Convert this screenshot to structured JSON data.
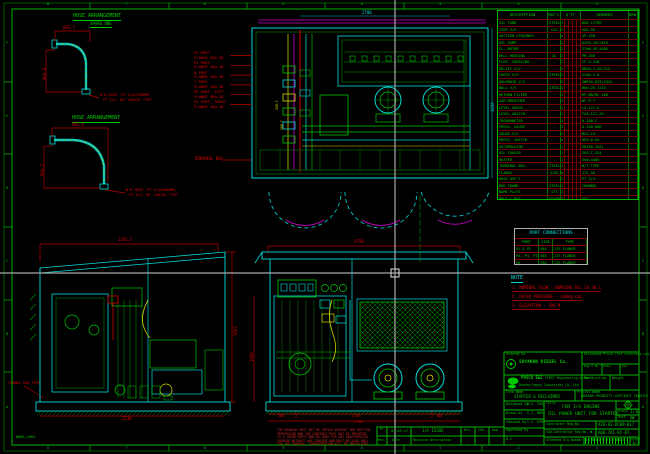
{
  "frame": {
    "corner_label": "WORK-2004",
    "ruler_numbers": [
      "8",
      "7",
      "6",
      "5",
      "4",
      "3",
      "2",
      "1"
    ],
    "ruler_letters": [
      "F",
      "E",
      "D",
      "C",
      "B",
      "A"
    ]
  },
  "colors": {
    "green": "#00c800",
    "cyan": "#00dcdc",
    "red": "#c80000",
    "yellow": "#d8d800",
    "magenta": "#cc00cc",
    "crosshair": "#aaaaaa"
  },
  "hose_arrangements": [
    {
      "title": "HOSE ARRANGEMENT",
      "subtitle": "SPARE ONE",
      "dim_w": "605.7",
      "dim_h": "450.8",
      "note_line1": "W'D HOSE, PT 3/4x1500MM",
      "note_line2": "PT 3/4, 90' SWIVEL TYPE"
    },
    {
      "title": "HOSE ARRANGEMENT",
      "subtitle": "",
      "dim_w": "905.5",
      "dim_h": "550.7",
      "note_line1": "W'D HOSE, PT 3/4x3000MM",
      "note_line2": "PT 3/4, 90' SWIVEL TYPE"
    }
  ],
  "plan_view": {
    "port_labels": [
      {
        "port": "P1 PORT",
        "flange": "FLANGE 50A-5K"
      },
      {
        "port": "P2 PORT",
        "flange": "FLANGE 50A-5K"
      },
      {
        "port": "N PORT",
        "flange": "FLANGE 40A-5K"
      },
      {
        "port": "T PORT",
        "flange": "FLANGE 50A-5K"
      },
      {
        "port": "P4 PORT, LEFT",
        "flange": "FLANGE 50A-5K"
      },
      {
        "port": "P5 PORT, RIGHT",
        "flange": "FLANGE 50A-5K"
      }
    ],
    "terminal_box": "TERMINAL BOX",
    "dim_top": "2700",
    "dim_right": "1650",
    "dim_a": "150.3",
    "dim_b": "100.7"
  },
  "bom": {
    "headers": {
      "description": "DESCRIPTION",
      "material": "MAT'L",
      "qty": "Q'TY",
      "remarks": "REMARKS",
      "dwg": "DRW'G NO"
    },
    "rows": [
      {
        "d": "OIL TANK",
        "m": "STEEL",
        "q": "1",
        "r": "800 LITER"
      },
      {
        "d": "STOP V/V",
        "m": "CAC",
        "q": "2",
        "r": "50A-5K"
      },
      {
        "d": "SUCTION STRAINER",
        "m": "-",
        "q": "2",
        "r": "SP-100"
      },
      {
        "d": "OIL PUMP",
        "m": "-",
        "q": "2",
        "r": "A2F0-107/61R"
      },
      {
        "d": "EL. MOTOR",
        "m": "-",
        "q": "2",
        "r": "37kW-4P-440V"
      },
      {
        "d": "BELL HOUSING",
        "m": "AL",
        "q": "2",
        "r": "PM-350"
      },
      {
        "d": "FLEX. COUPLING",
        "m": "-",
        "q": "2",
        "r": "CF-A-110"
      },
      {
        "d": "RELIEF V/V",
        "m": "-",
        "q": "2",
        "r": "DB20-2-50/315"
      },
      {
        "d": "CHECK V/V",
        "m": "STEEL",
        "q": "2",
        "r": "S20A-1.0"
      },
      {
        "d": "SOLENOID V/V",
        "m": "-",
        "q": "2",
        "r": "4WE10-D33/CG24"
      },
      {
        "d": "BALL V/V",
        "m": "STEEL",
        "q": "4",
        "r": "BKH-20-1113"
      },
      {
        "d": "RETURN FILTER",
        "m": "-",
        "q": "1",
        "r": "RF-BN/HC-160"
      },
      {
        "d": "AIR BREATHER",
        "m": "-",
        "q": "1",
        "r": "BF-P-7"
      },
      {
        "d": "LEVEL GAUGE",
        "m": "-",
        "q": "1",
        "r": "LS-127-A"
      },
      {
        "d": "LEVEL SWITCH",
        "m": "-",
        "q": "1",
        "r": "FSA-127-2X"
      },
      {
        "d": "THERMOMETER",
        "m": "-",
        "q": "1",
        "r": "0-100'C"
      },
      {
        "d": "PRESS. GAUGE",
        "m": "-",
        "q": "3",
        "r": "0-250 BAR"
      },
      {
        "d": "GAUGE V/V",
        "m": "-",
        "q": "3",
        "r": "BV2-10"
      },
      {
        "d": "PRESS. SWITCH",
        "m": "-",
        "q": "2",
        "r": "HED-8-OA"
      },
      {
        "d": "ACCUMULATOR",
        "m": "-",
        "q": "1",
        "r": "SB330-32A1"
      },
      {
        "d": "OIL COOLER",
        "m": "-",
        "q": "1",
        "r": "SUS-T-424"
      },
      {
        "d": "HEATER",
        "m": "-",
        "q": "1",
        "r": "3kW-440V"
      },
      {
        "d": "TERMINAL BOX",
        "m": "STEEL",
        "q": "1",
        "r": "W/T TYPE"
      },
      {
        "d": "FLANGE",
        "m": "S25C",
        "q": "6",
        "r": "JIS 5K"
      },
      {
        "d": "HOSE ASS'Y",
        "m": "-",
        "q": "2",
        "r": "PT 3/4"
      },
      {
        "d": "BED FRAME",
        "m": "STEEL",
        "q": "1",
        "r": "CHANNEL"
      },
      {
        "d": "NAME PLATE",
        "m": "STS",
        "q": "1",
        "r": "-"
      },
      {
        "d": "BOLT & NUT",
        "m": "SS400",
        "q": "1",
        "r": "SET"
      }
    ]
  },
  "port_connections": {
    "title": "PORT CONNECTIONS",
    "headers": [
      "PORT",
      "SIZE",
      "TYPE"
    ],
    "rows": [
      [
        "P1 & P2",
        "50A",
        "JIS FLANGE"
      ],
      [
        "P3, P4, P5",
        "40A",
        "JIS FLANGE"
      ],
      [
        "P6",
        "25A",
        "JIS FLANGE"
      ]
    ]
  },
  "notes": {
    "title": "NOTE",
    "items": [
      "1. NOMINAL FLOW - WORKING OIL 50 40 L",
      "2. RATED PRESSURE - 140kg/cm2",
      "3. ELEVATION : 700 M"
    ]
  },
  "side_view": {
    "dim_top": "2285.5",
    "dim_right": "1563",
    "dim_bottom": "2130",
    "label": "FLANGE 50A TYPE"
  },
  "front_view": {
    "dim_top": "2750",
    "dim_left": "1050",
    "dim_b1": "300",
    "dim_b2": "2150",
    "dim_b3": "300",
    "dim_total": "2750"
  },
  "warning_lines": [
    "THE DRAWING MUST NOT BE COPIED WITHOUT OUR WRITTEN",
    "PERMISSION AND THE CONTENTS MUST NOT BE IMPARTED",
    "TO A THIRD PARTY NOR BE USED FOR ANY UNAUTHORIZED",
    "PURPOSE WITHOUT OUR CONSENT AND MUST BE USED ONLY",
    "FOR THE PURPOSE. CONTRAVENTION WILL BE PROSECUTED."
  ],
  "revision": {
    "rev": "A",
    "date": "'04.03.17",
    "desc": "1st ISSUE",
    "col_rev": "Rev.",
    "col_date": "Date",
    "col_desc": "Revision Description",
    "sign_cols": [
      "Drw",
      "Chk",
      "App"
    ],
    "sign_vals": [
      "-",
      "-",
      "-"
    ]
  },
  "title_block": {
    "ordered_label": "Ordered by",
    "company": "SOYAKAN DIESEL Co.",
    "est_label": "Estimated Price (for reference use)",
    "est_value": "-",
    "mini_cells": [
      {
        "l": "Dwg'd By",
        "v": "-"
      },
      {
        "l": "Date",
        "v": "-"
      },
      {
        "l": "Rev.",
        "v": "-"
      }
    ],
    "matl_label": "Mat'l",
    "matl_value": "-",
    "weight_label": "Weight",
    "weight_value": "-",
    "eng_brand": "POSCO E&C",
    "eng_name": "FIRST Engineering & Construction",
    "eng2_name": "Doosan Heavy Industries Co.,Ltd",
    "item_label": "Item Name",
    "item_value": "STARTER & RECLAIMER",
    "project_label": "Project Name",
    "project_value": "DOOSAN PRIORITY-AIRTIGHT SERVICE",
    "sign_rows": [
      {
        "label": "Designed by",
        "name": "H.S. CHA"
      },
      {
        "label": "Drawn by",
        "name": "S.I. WOO"
      },
      {
        "label": "Checked by",
        "name": "Y.S. KIM"
      },
      {
        "label": "Approved by",
        "name": "-"
      },
      {
        "label": "Q.C.",
        "name": "-"
      }
    ],
    "title_label": "Title",
    "title_line1": "FOR 1/4 ENGINE",
    "title_line2": "OIL POWER UNIT FOR STARTER",
    "scale_label": "Scale",
    "scale_value": "1/10",
    "unit_label": "Unit",
    "unit_value": "mm",
    "contractor_label": "Contractor Reg.No.",
    "contractor_value": "ATD-03-DC09-017",
    "subcontractor_label": "Sub-Contractor Reg.No.",
    "subcontractor_value": "A06-7A1-01-07",
    "std_label": "Standard Drg Number",
    "barcode_text": "170409417064130",
    "sheet_label": "Sheet",
    "sheet_value": "1/1",
    "stamp": "✱"
  }
}
